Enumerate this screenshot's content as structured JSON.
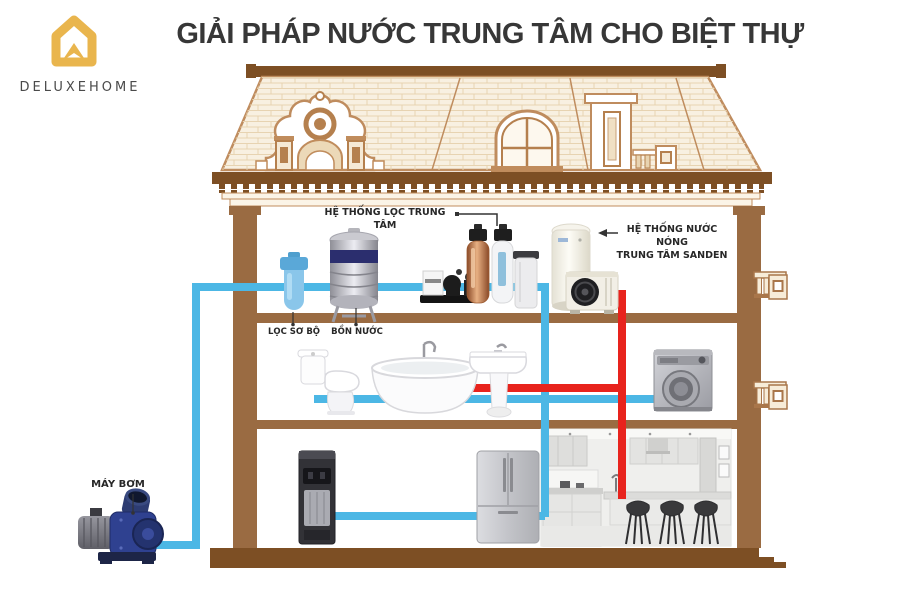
{
  "header": {
    "title": "GIẢI PHÁP NƯỚC TRUNG TÂM CHO BIỆT THỰ",
    "logo_text": "DELUXEHOME"
  },
  "labels": {
    "central_filter": "HỆ THỐNG LỌC TRUNG TÂM",
    "hot_water_line1": "HỆ THỐNG NƯỚC NÓNG",
    "hot_water_line2": "TRUNG TÂM SANDEN",
    "pre_filter": "LỌC SƠ BỘ",
    "water_tank": "BỒN NƯỚC",
    "pump": "MÁY BƠM"
  },
  "colors": {
    "cold_pipe": "#4cb7e5",
    "hot_pipe": "#e8231d",
    "wall": "#9a6b42",
    "dark_brown": "#7d4f24",
    "roof_outline": "#bf8c5e",
    "roof_fill": "#f8f0e1",
    "brand_gold": "#e9b54d",
    "title_color": "#373737"
  },
  "icons": [
    "deluxehome-logo-icon",
    "pre-filter-icon",
    "water-tank-icon",
    "booster-pump-set-icon",
    "filter-column-copper-icon",
    "filter-column-white-icon",
    "brine-tank-icon",
    "hot-water-cylinder-icon",
    "heat-pump-unit-icon",
    "toilet-icon",
    "bathtub-icon",
    "pedestal-sink-icon",
    "washing-machine-icon",
    "water-dispenser-icon",
    "refrigerator-icon",
    "kitchen-scene",
    "water-pump-icon"
  ]
}
